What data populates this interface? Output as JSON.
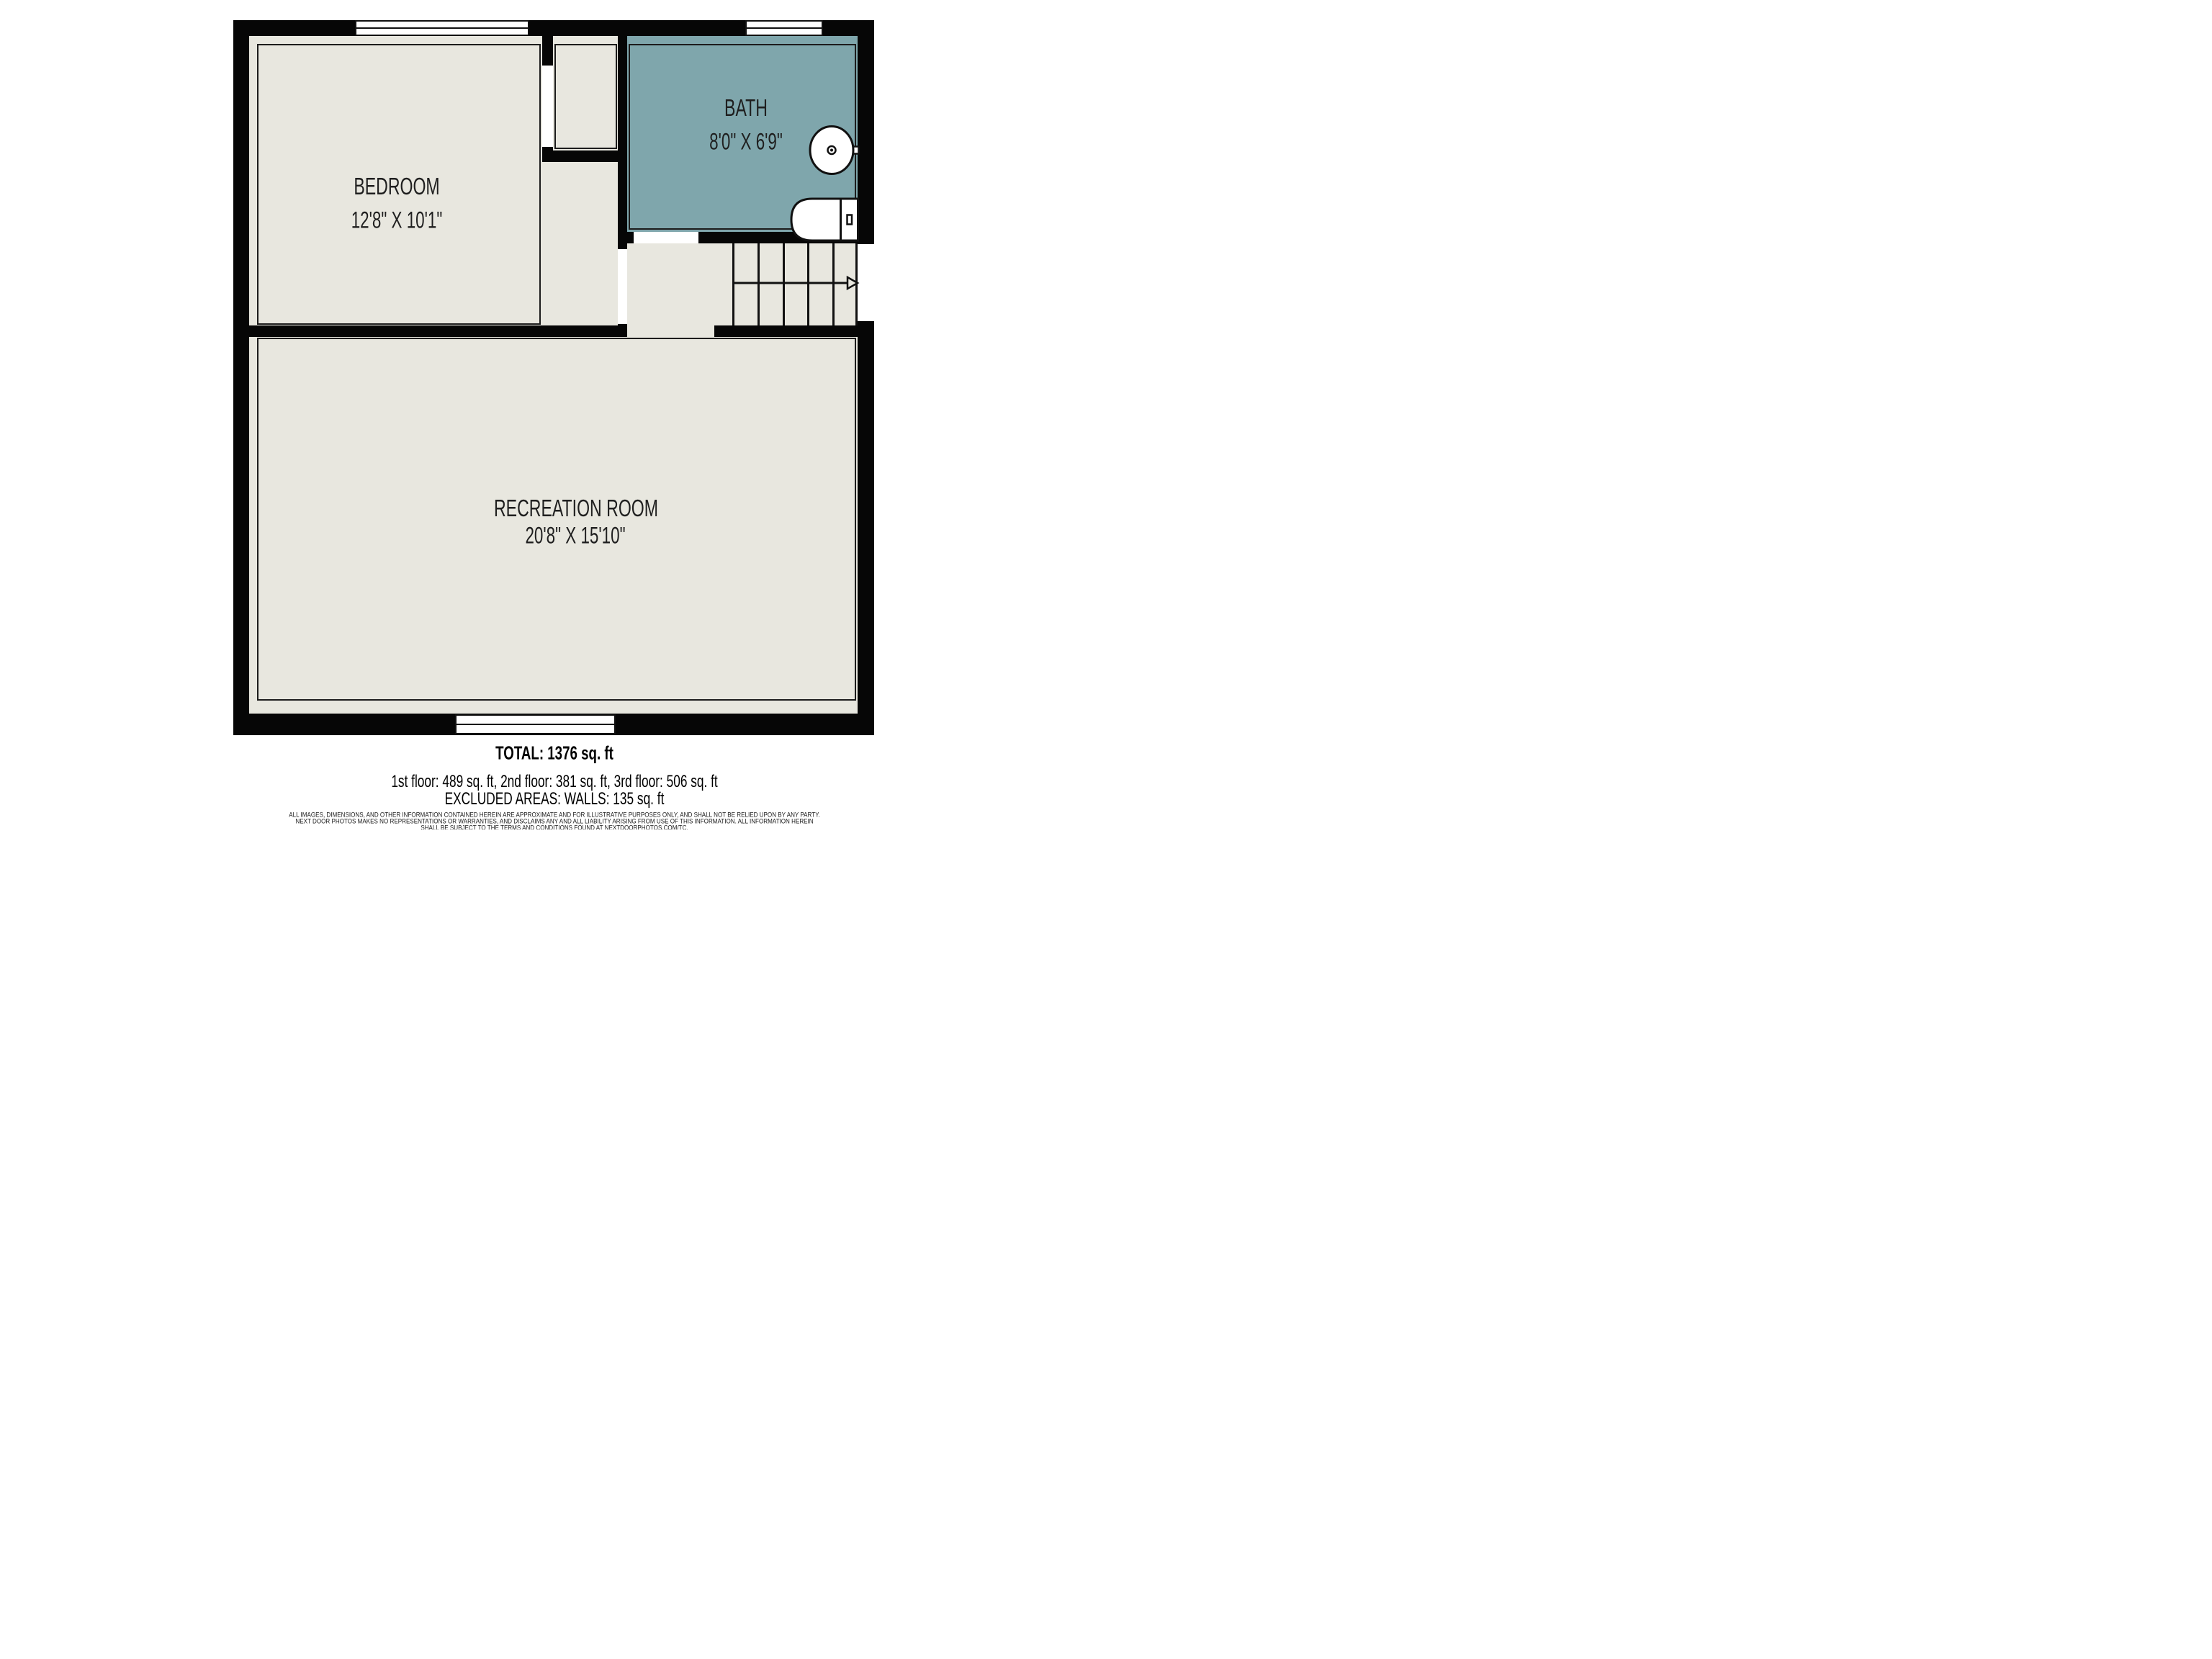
{
  "rooms": {
    "bedroom": {
      "name": "BEDROOM",
      "dims": "12'8\" X 10'1\""
    },
    "bath": {
      "name": "BATH",
      "dims": "8'0\" X 6'9\""
    },
    "recreation": {
      "name": "RECREATION ROOM",
      "dims": "20'8\" X 15'10\""
    }
  },
  "footer": {
    "total": "TOTAL: 1376 sq. ft",
    "floors": "1st floor: 489 sq. ft, 2nd floor: 381 sq. ft, 3rd floor: 506 sq. ft",
    "excluded": "EXCLUDED AREAS: WALLS: 135 sq. ft",
    "disclaimer_line1": "ALL IMAGES, DIMENSIONS, AND OTHER INFORMATION CONTAINED HEREIN ARE APPROXIMATE AND FOR ILLUSTRATIVE PURPOSES ONLY, AND SHALL NOT BE RELIED UPON BY ANY PARTY.",
    "disclaimer_line2": "NEXT DOOR PHOTOS MAKES NO REPRESENTATIONS OR WARRANTIES, AND DISCLAIMS ANY AND ALL LIABILITY ARISING FROM USE OF THIS INFORMATION. ALL INFORMATION HEREIN",
    "disclaimer_line3": "SHALL BE SUBJECT TO THE TERMS AND CONDITIONS FOUND AT NEXTDOORPHOTOS.COM/TC."
  },
  "icons": {
    "sink": "sink-icon",
    "toilet": "toilet-icon",
    "stairs_arrow": "stairs-direction-arrow-icon",
    "windows": "window-symbol"
  },
  "colors": {
    "wall": "#060606",
    "room_fill": "#e8e7df",
    "bath_fill": "#7fa6ac",
    "line": "#1c1c1c"
  }
}
